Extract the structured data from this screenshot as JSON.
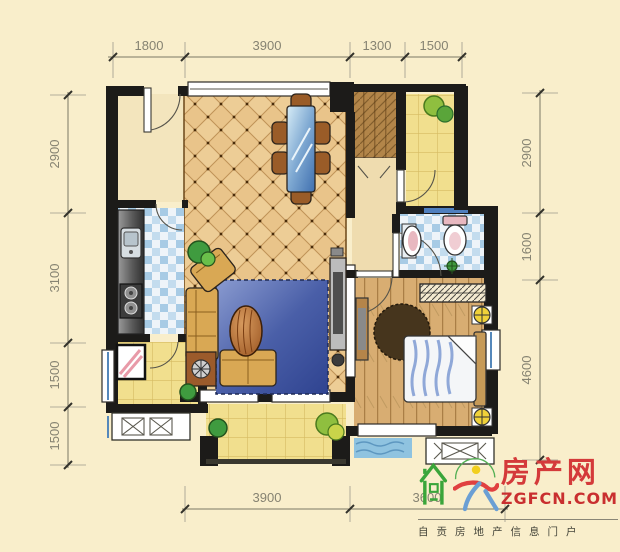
{
  "background_color": "#f9eecb",
  "dimensions": {
    "top": [
      "1800",
      "3900",
      "1300",
      "1500"
    ],
    "left": [
      "2900",
      "3100",
      "1500",
      "1500"
    ],
    "right": [
      "2900",
      "1600",
      "4600"
    ],
    "bottom": [
      "3900",
      "3600"
    ]
  },
  "logo": {
    "site_name": "房产网",
    "site_url": "ZGFCN.COM",
    "tagline": "自贡房地产信息门户",
    "colors": {
      "red": "#d43a3a",
      "green": "#3aa53a",
      "blue": "#6b9fd4",
      "yellow": "#f2cf1f"
    }
  },
  "icons": {
    "logo_house": "house-icon",
    "logo_cloud": "cloud-swirl-icon",
    "plant": "plant-icon",
    "ac_platform": "ac-unit-symbol",
    "bedside_lamp": "lamp-symbol",
    "stove": "stove-icon",
    "sink": "sink-icon",
    "toilet": "toilet-icon",
    "washing_machine": "washing-machine-icon"
  }
}
